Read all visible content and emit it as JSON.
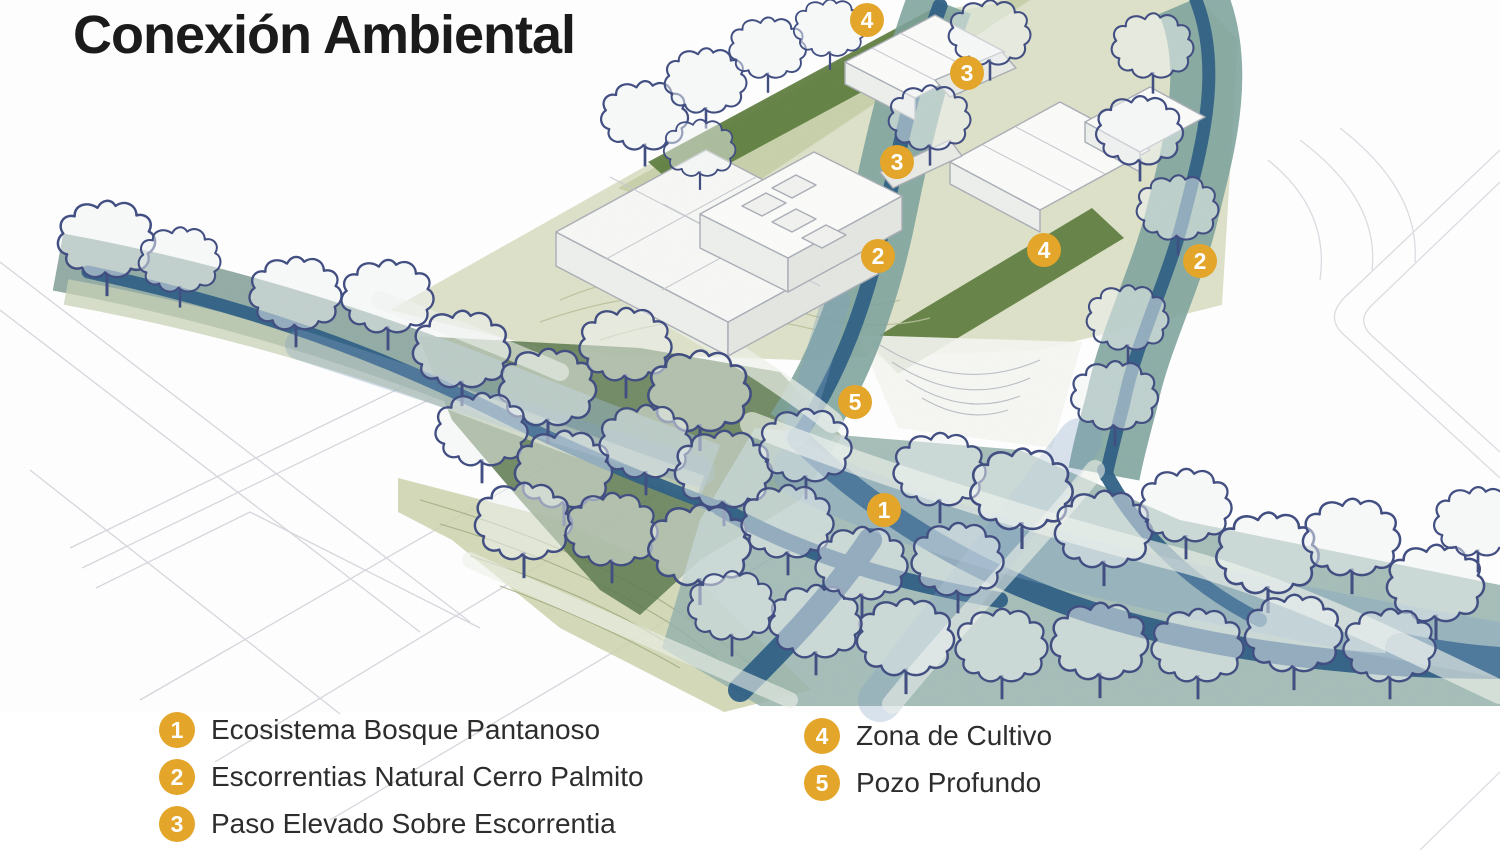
{
  "title": "Conexión Ambiental",
  "colors": {
    "marker": "#E3A52A",
    "marker_text": "#FFFFFF",
    "title_text": "#1B1B1B",
    "legend_text": "#2D2D2D",
    "stream_dark_blue": "#2E5F84",
    "stream_teal_band": "#7CA29B",
    "swamp_wash": "#95B1AC",
    "forest_green": "#5E7B50",
    "hedge_green": "#5B7B3C",
    "site_olive": "#DBDFC5",
    "tree_outline_navy": "#3F4C80"
  },
  "legend": {
    "columns": [
      {
        "items": [
          {
            "number": "1",
            "label": "Ecosistema Bosque Pantanoso"
          },
          {
            "number": "2",
            "label": "Escorrentias Natural Cerro Palmito"
          },
          {
            "number": "3",
            "label": "Paso Elevado Sobre Escorrentia"
          }
        ]
      },
      {
        "items": [
          {
            "number": "4",
            "label": "Zona de Cultivo"
          },
          {
            "number": "5",
            "label": "Pozo Profundo"
          }
        ]
      }
    ]
  },
  "map": {
    "markers": [
      {
        "number": "4",
        "x": 867,
        "y": 20,
        "label": "Zona de Cultivo"
      },
      {
        "number": "3",
        "x": 967,
        "y": 73,
        "label": "Paso Elevado Sobre Escorrentia"
      },
      {
        "number": "3",
        "x": 897,
        "y": 162,
        "label": "Paso Elevado Sobre Escorrentia"
      },
      {
        "number": "2",
        "x": 878,
        "y": 256,
        "label": "Escorrentias Natural Cerro Palmito"
      },
      {
        "number": "4",
        "x": 1044,
        "y": 250,
        "label": "Zona de Cultivo"
      },
      {
        "number": "2",
        "x": 1200,
        "y": 261,
        "label": "Escorrentias Natural Cerro Palmito"
      },
      {
        "number": "5",
        "x": 855,
        "y": 402,
        "label": "Pozo Profundo"
      },
      {
        "number": "1",
        "x": 884,
        "y": 510,
        "label": "Ecosistema Bosque Pantanoso"
      }
    ]
  }
}
